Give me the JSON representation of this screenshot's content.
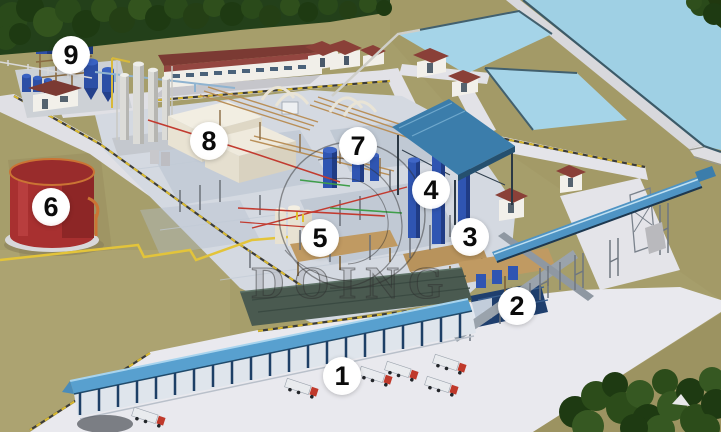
{
  "watermark": {
    "brand": "DOING"
  },
  "markers": [
    {
      "number": "1",
      "x": 342,
      "y": 376
    },
    {
      "number": "2",
      "x": 517,
      "y": 306
    },
    {
      "number": "3",
      "x": 470,
      "y": 237
    },
    {
      "number": "4",
      "x": 431,
      "y": 190
    },
    {
      "number": "5",
      "x": 320,
      "y": 238
    },
    {
      "number": "6",
      "x": 51,
      "y": 207
    },
    {
      "number": "7",
      "x": 358,
      "y": 146
    },
    {
      "number": "8",
      "x": 209,
      "y": 141
    },
    {
      "number": "9",
      "x": 71,
      "y": 55
    }
  ],
  "colors": {
    "ground": "#a69e6b",
    "pool_water": "#9fd0e4",
    "road": "#e5e5ea",
    "plant_slab": "#d4d9e1",
    "tank_red": "#a83030",
    "tank_blue": "#2c4fa6",
    "canopy_blue": "#3b7dab",
    "conveyor_blue": "#4f94c4",
    "roof_red": "#7b3a33",
    "truck_cab_red": "#c0392b",
    "tree_green": "#2a4a1a",
    "pipe_yellow": "#d9b92f",
    "pipe_red": "#c23b30",
    "pipe_green": "#3f9e4a",
    "marker_bg": "#ffffff",
    "marker_text": "#0b0b0b",
    "watermark_gray": "#2f2f2f"
  }
}
